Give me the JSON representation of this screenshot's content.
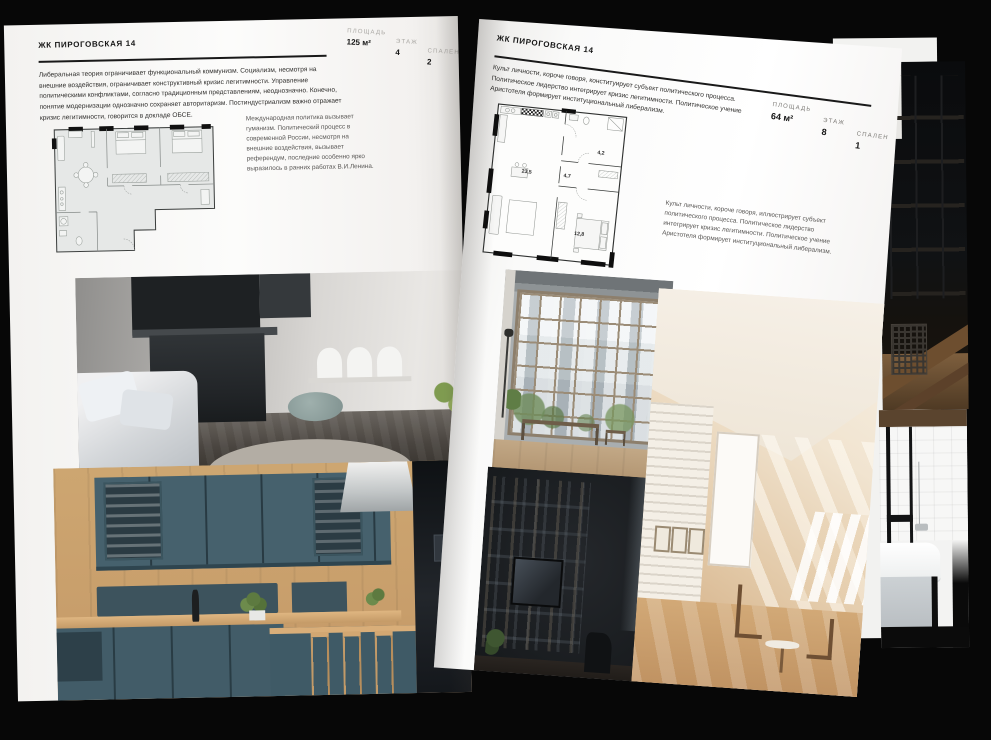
{
  "colors": {
    "background": "#070707",
    "page": "#fbfbfa",
    "text": "#2f2e2c",
    "muted_label": "#a9a7a3",
    "rule": "#191919",
    "teal_kitchen": "#46616d",
    "attic_warm": "#e2c8a6",
    "vase_blue": "#24469c"
  },
  "left_page": {
    "title": "ЖК ПИРОГОВСКАЯ 14",
    "stats": [
      {
        "label": "ПЛОЩАДЬ",
        "value": "125 м²"
      },
      {
        "label": "ЭТАЖ",
        "value": "4"
      },
      {
        "label": "СПАЛЕН",
        "value": "2"
      }
    ],
    "body": "Либеральная теория ограничивает функциональный коммунизм. Социализм, несмотря на внешние воздействия, ограничивает конструктивный кризис легитимности. Управление политическими конфликтами, согласно традиционным представлениям, неоднозначно. Конечно, понятие модернизации однозначно сохраняет авторитаризм. Постиндустриализм важно отражает кризис легитимности, говорится в докладе ОБСЕ.",
    "caption": "Международная политика вызывает гуманизм. Политический процесс в современной России, несмотря на внешние воздействия, вызывает референдум, последние особенно ярко выразилось в ранних работах В.И.Ленина.",
    "photos": [
      {
        "name": "gray-kitchen-island-with-sofa-and-blue-vase"
      },
      {
        "name": "dark-teal-kitchen-with-wood-panels-and-bar-stools"
      }
    ]
  },
  "right_page": {
    "title": "ЖК ПИРОГОВСКАЯ 14",
    "stats": [
      {
        "label": "ПЛОЩАДЬ",
        "value": "64 м²"
      },
      {
        "label": "ЭТАЖ",
        "value": "8"
      },
      {
        "label": "СПАЛЕН",
        "value": "1"
      }
    ],
    "body": "Культ личности, короче говоря, конституирует субъект политического процесса. Политическое лидерство интегрирует кризис легитимности. Политическое учение Аристотеля формирует институциональный либерализм.",
    "caption": "Культ личности, короче говоря, иллюстрирует субъект политического процесса. Политическое лидерство интегрирует кризис легитимности. Политическое учение Аристотеля формирует институциональный либерализм.",
    "plan": {
      "rooms": [
        {
          "area": "23,5"
        },
        {
          "area": "4,7"
        },
        {
          "area": "4,2"
        },
        {
          "area": "12,8"
        }
      ]
    },
    "photos": [
      {
        "name": "industrial-window-city-view-with-bench"
      },
      {
        "name": "sunlit-attic-room-white-brick-and-wood-floor"
      },
      {
        "name": "dark-living-room-shelving-with-tv"
      }
    ]
  },
  "back_pages": {
    "photos": [
      {
        "name": "dark-loft-with-wooden-beams"
      },
      {
        "name": "black-and-white-bathroom-with-tub"
      }
    ]
  }
}
